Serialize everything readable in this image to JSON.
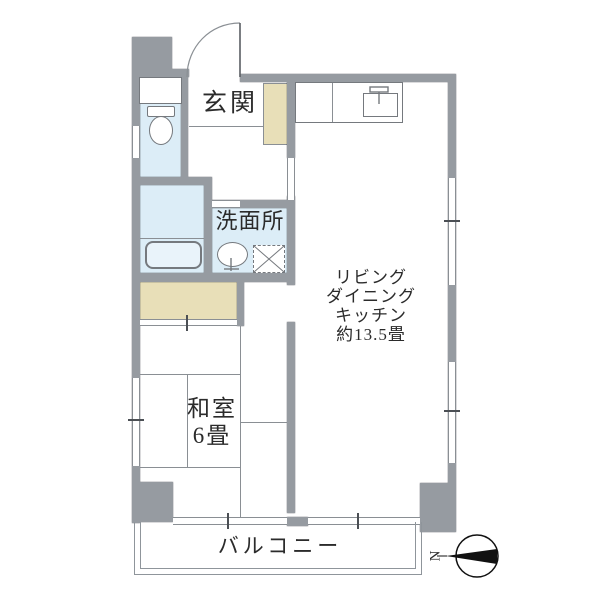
{
  "title": "apartment-floor-plan",
  "rooms": {
    "genkan": {
      "label": "玄関"
    },
    "washroom": {
      "label": "洗面所"
    },
    "ldk": {
      "lines": [
        "リビング",
        "ダイニング",
        "キッチン",
        "約13.5畳"
      ]
    },
    "washitsu": {
      "lines": [
        "和室",
        "6畳"
      ]
    },
    "balcony": {
      "label": "バルコニー"
    }
  },
  "compass": {
    "label": "N"
  },
  "colors": {
    "wall": "#969ba1",
    "water": "#dcedf7",
    "closet": "#e8dfb8",
    "line": "#8a8f94",
    "fixture": "#75797e",
    "text": "#2b2b2b"
  }
}
